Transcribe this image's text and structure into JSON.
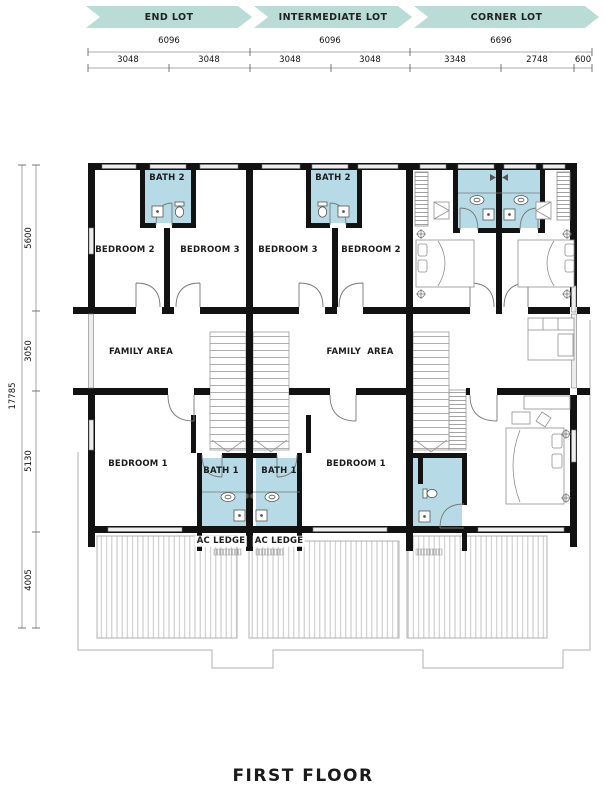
{
  "title": "FIRST FLOOR",
  "banners": [
    {
      "label": "END LOT"
    },
    {
      "label": "INTERMEDIATE LOT"
    },
    {
      "label": "CORNER LOT"
    }
  ],
  "dims": {
    "top_row1": [
      "6096",
      "6096",
      "6696"
    ],
    "top_row2": [
      "3048",
      "3048",
      "3048",
      "3048",
      "3348",
      "2748",
      "600"
    ],
    "left_total": "17785",
    "left_segments": [
      "5600",
      "3050",
      "5130",
      "4005"
    ]
  },
  "rooms": {
    "end": {
      "bath2": "BATH 2",
      "bedroom2": "BEDROOM 2",
      "bedroom3": "BEDROOM 3",
      "family": "FAMILY AREA",
      "bedroom1": "BEDROOM 1",
      "bath1": "BATH 1",
      "ac_ledge": "AC LEDGE"
    },
    "intermediate": {
      "bath2": "BATH 2",
      "bedroom3": "BEDROOM 3",
      "bedroom2": "BEDROOM 2",
      "family": "FAMILY  AREA",
      "bedroom1": "BEDROOM 1",
      "bath1": "BATH 1",
      "ac_ledge": "AC LEDGE"
    }
  },
  "colors": {
    "banner": "#b9ddd6",
    "bath": "#b6dbe6",
    "wall": "#121212"
  }
}
